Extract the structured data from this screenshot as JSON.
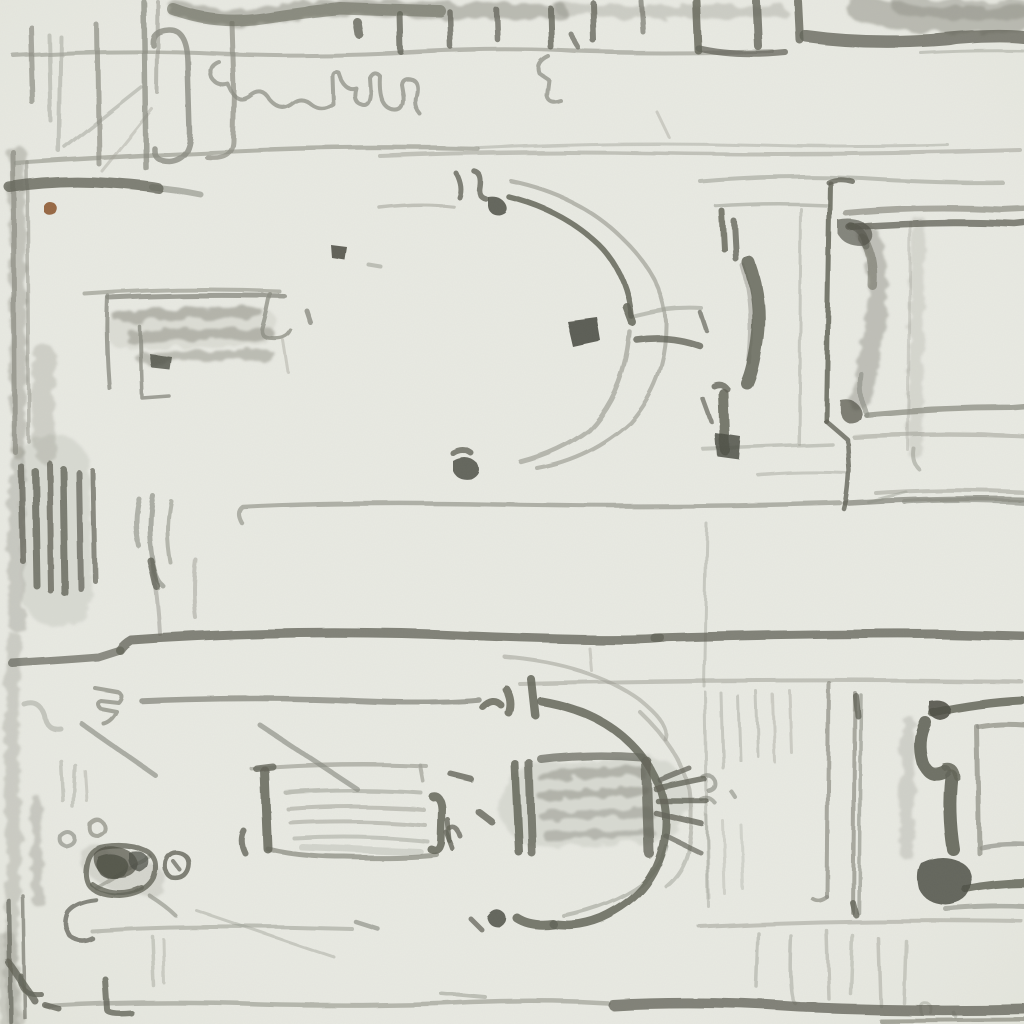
{
  "artwork": {
    "kind": "graphite pencil sketch on paper",
    "subject": "architectural facade study drawn sideways: two registers with arched openings, shaded window panels, cornice lines, heavy margin hatching at left and a small figure scribble",
    "registers": [
      {
        "name": "upper",
        "elements": [
          "horseshoe arch opening left with centre dot",
          "hatched window panel",
          "bracketed pilaster",
          "large moulded frame at right"
        ]
      },
      {
        "name": "lower",
        "elements": [
          "arch opening left with hatched infill and radiating keystone strokes",
          "hatched window panel",
          "double drafted verticals",
          "capital-and-base frame at right"
        ]
      }
    ],
    "extras": [
      "tick-mark comb along top edge",
      "meandering handwriting-like scribble upper left",
      "rust fleck on paper",
      "figure scribble lower left"
    ]
  },
  "colors": {
    "paper": "#e9eae3",
    "paper_edge": "#dfe1d6",
    "grain": "#6f7066",
    "graphite_faint": "#b4b5ab",
    "graphite_light": "#a0a197",
    "graphite_medium": "#8b8c82",
    "graphite_dark": "#636458",
    "graphite_deep": "#4e4f45",
    "rust_fleck": "#8e5a32"
  }
}
